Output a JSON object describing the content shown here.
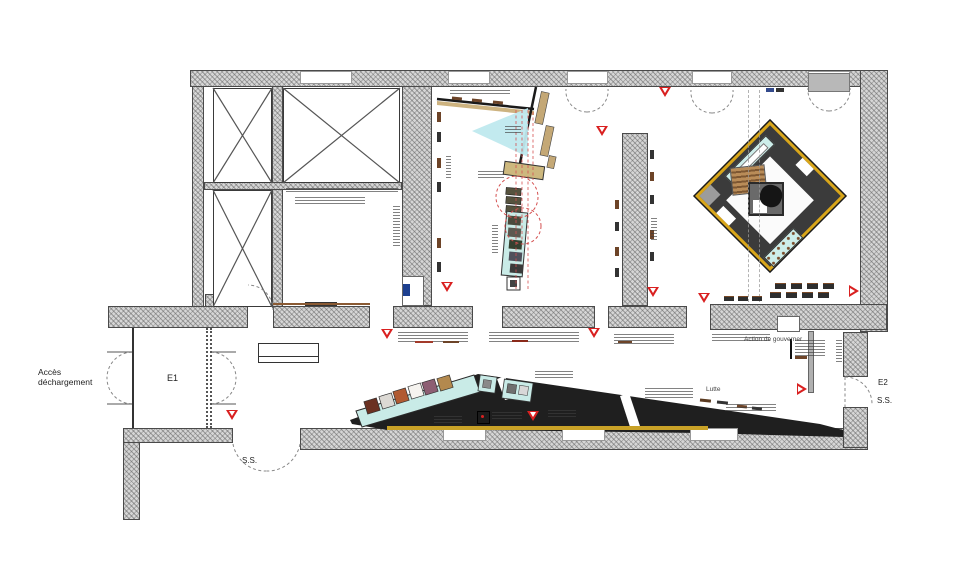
{
  "plan": {
    "labels": {
      "access_line1": "Accès",
      "access_line2": "déchargement",
      "entrance_e1": "E1",
      "stair_ss_left": "S.S.",
      "entrance_e2": "E2",
      "stair_ss_right": "S.S.",
      "zone_action": "Action de gouverner",
      "zone_lutte": "Lutte"
    },
    "palette": {
      "wall_fill": "#d6d6d6",
      "marker_red": "#d92020",
      "band_black": "#1f1f1f",
      "case_teal": "#c9ebe7",
      "cone_cyan": "#bfe9ee",
      "gold_border": "#d9a61a",
      "yellow_line": "#c9a227",
      "sign_blue": "#1d3f8f",
      "artwork_colors": [
        "#6b3122",
        "#dcd9d4",
        "#b15a32",
        "#f5f3ef",
        "#8d5e73",
        "#b3894e"
      ]
    }
  }
}
